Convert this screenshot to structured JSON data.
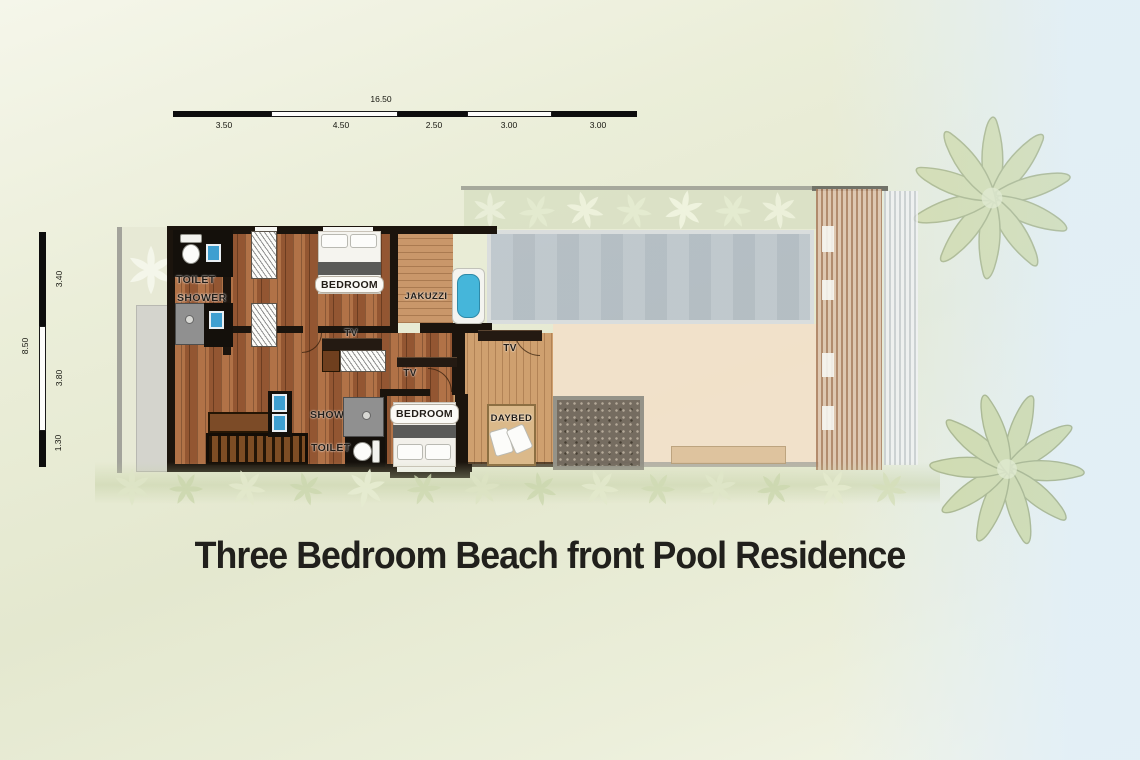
{
  "title": "Three Bedroom Beach front Pool Residence",
  "plan": {
    "labels": {
      "toilet_upper": "TOILET",
      "shower_upper": "SHOWER",
      "bedroom_upper": "BEDROOM",
      "jakuzzi": "JAKUZZI",
      "tv_living": "TV",
      "tv_hall": "TV",
      "tv_deck": "TV",
      "shower_lower": "SHOWER",
      "toilet_lower": "TOILET",
      "bedroom_lower": "BEDROOM",
      "daybed": "DAYBED"
    }
  },
  "scale_bars": {
    "horizontal": {
      "total_label": "16.50",
      "segment_labels": [
        "3.50",
        "4.50",
        "2.50",
        "3.00",
        "3.00"
      ]
    },
    "vertical": {
      "total_label": "8.50",
      "segment_labels": [
        "3.40",
        "3.80",
        "1.30"
      ]
    }
  },
  "colors": {
    "background": "#e9ecd8",
    "background_right": "#e2eff7",
    "wall": "#1b140d",
    "wood_floor": "#a2613a",
    "wood_deck": "#c9976a",
    "terrace": "#f2dfc9",
    "pool_water": "#b7c1ca",
    "jacuzzi_water": "#45b6da",
    "sink_water": "#3f9fd0",
    "hedge_green": "#d8dfc3",
    "palm_green": "#c4d292",
    "pebble": "#6f665b",
    "stairs_wood": "#5d3a1e",
    "title_text": "#21201c"
  }
}
